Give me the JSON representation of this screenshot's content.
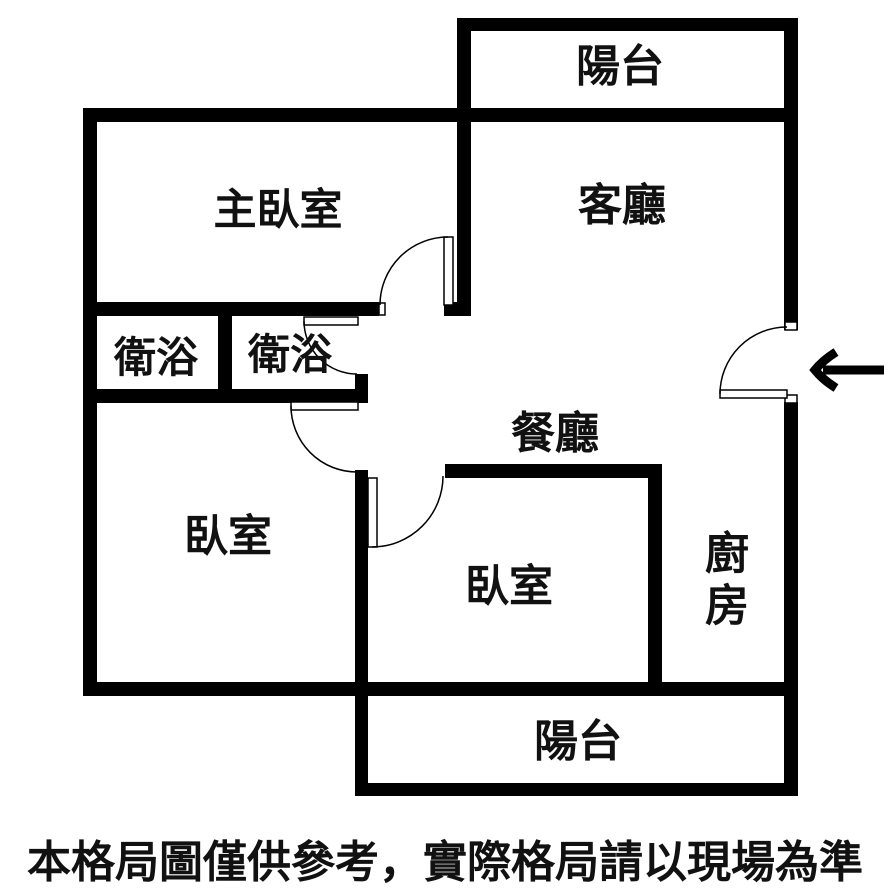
{
  "floor_plan": {
    "title": "apartment-floor-plan",
    "rooms": [
      {
        "id": "balcony-top",
        "label": "陽台"
      },
      {
        "id": "master-bedroom",
        "label": "主臥室"
      },
      {
        "id": "living-room",
        "label": "客廳"
      },
      {
        "id": "bathroom-1",
        "label": "衛浴"
      },
      {
        "id": "bathroom-2",
        "label": "衛浴"
      },
      {
        "id": "dining-room",
        "label": "餐廳"
      },
      {
        "id": "bedroom-left",
        "label": "臥室"
      },
      {
        "id": "bedroom-center",
        "label": "臥室"
      },
      {
        "id": "kitchen",
        "label": "廚房"
      },
      {
        "id": "balcony-bottom",
        "label": "陽台"
      }
    ],
    "entrance": {
      "indicator": "arrow-pointing-left-into-unit"
    },
    "disclaimer": "本格局圖僅供參考，實際格局請以現場為準",
    "colors": {
      "wall": "#000000",
      "background": "#ffffff",
      "text": "#111111"
    }
  }
}
